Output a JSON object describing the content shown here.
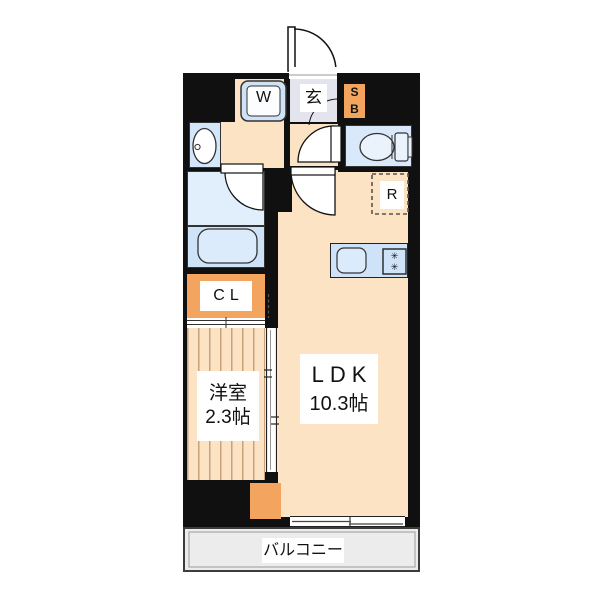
{
  "floorplan": {
    "rooms": {
      "entrance": {
        "label": "玄"
      },
      "washer": {
        "label": "W"
      },
      "shoe_box": {
        "line1": "S",
        "line2": "B"
      },
      "refrigerator": {
        "label": "R"
      },
      "closet": {
        "label": "CL"
      },
      "western_room": {
        "name": "洋室",
        "size": "2.3帖"
      },
      "ldk": {
        "name": "LDK",
        "size": "10.3帖"
      },
      "balcony": {
        "label": "バルコニー"
      }
    },
    "kitchen": {
      "burner_symbol": "✳"
    },
    "colors": {
      "wall": "#101010",
      "floor_cream": "#fbe3c3",
      "accent_orange": "#f3a45e",
      "water_blue": "#d4e6f9",
      "entrance_gray": "#e4e4ee",
      "balcony_gray": "#ececec"
    }
  }
}
